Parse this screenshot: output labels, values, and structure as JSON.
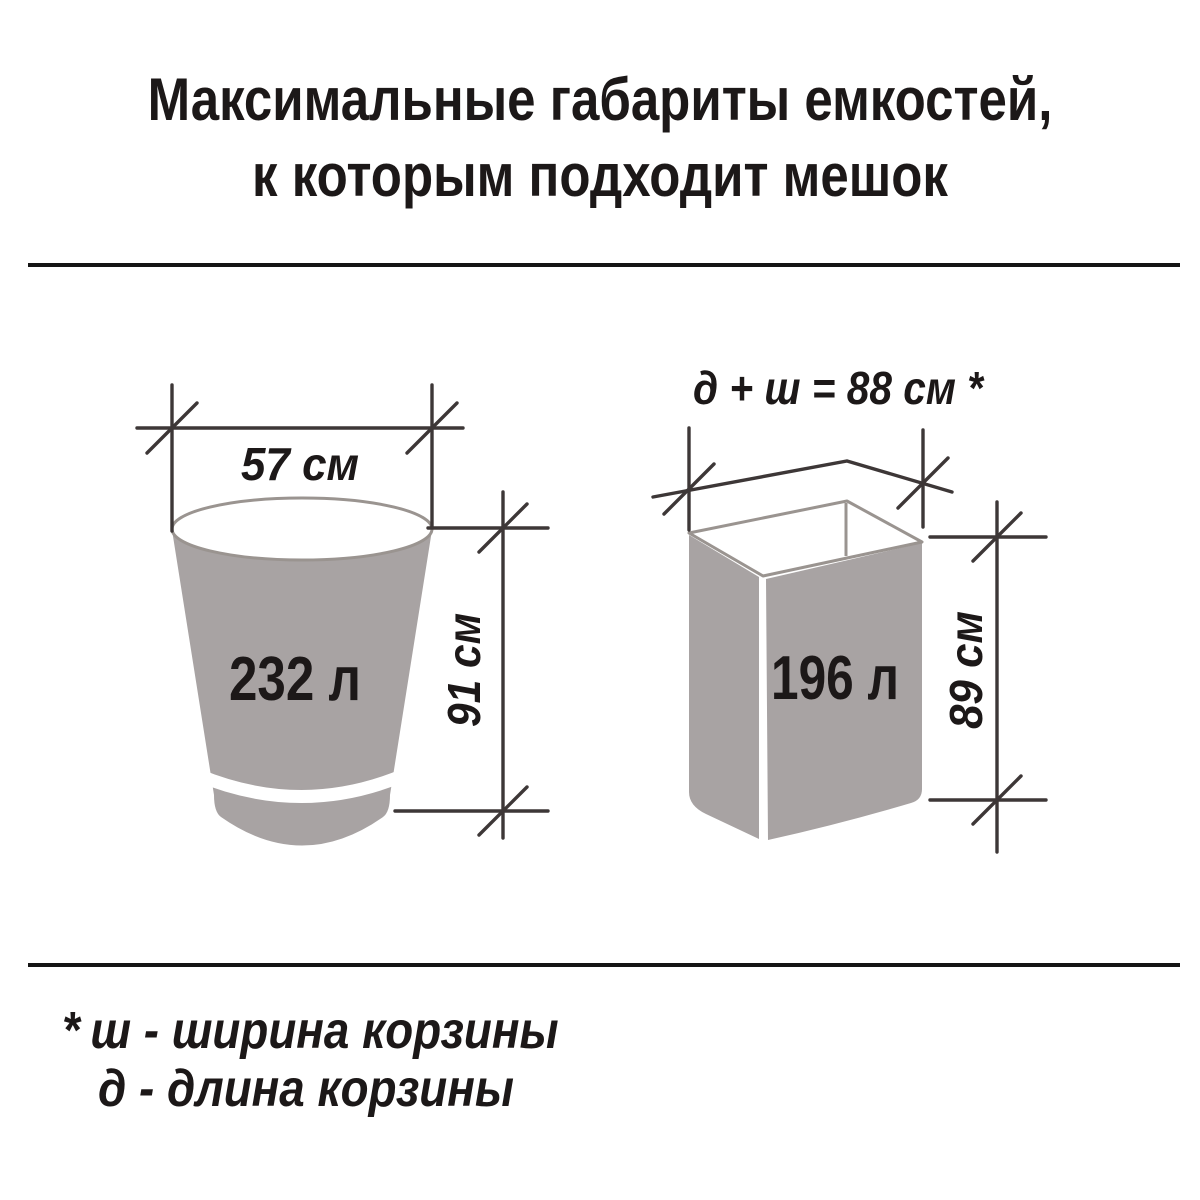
{
  "title": {
    "line1": "Максимальные габариты емкостей,",
    "line2": "к которым подходит мешок"
  },
  "bucket": {
    "volume_label": "232 л",
    "width_label": "57 см",
    "height_label": "91 см"
  },
  "box": {
    "volume_label": "196 л",
    "dimension_formula": "д + ш = 88 см *",
    "height_label": "89 см"
  },
  "footnote": {
    "marker": "*",
    "line1": "ш - ширина корзины",
    "line2": "д - длина корзины"
  },
  "colors": {
    "container_fill": "#a8a3a3",
    "container_outline": "#9a9490",
    "dimension_line": "#3d3737",
    "text": "#1c1818",
    "divider": "#151515",
    "background": "#ffffff"
  }
}
